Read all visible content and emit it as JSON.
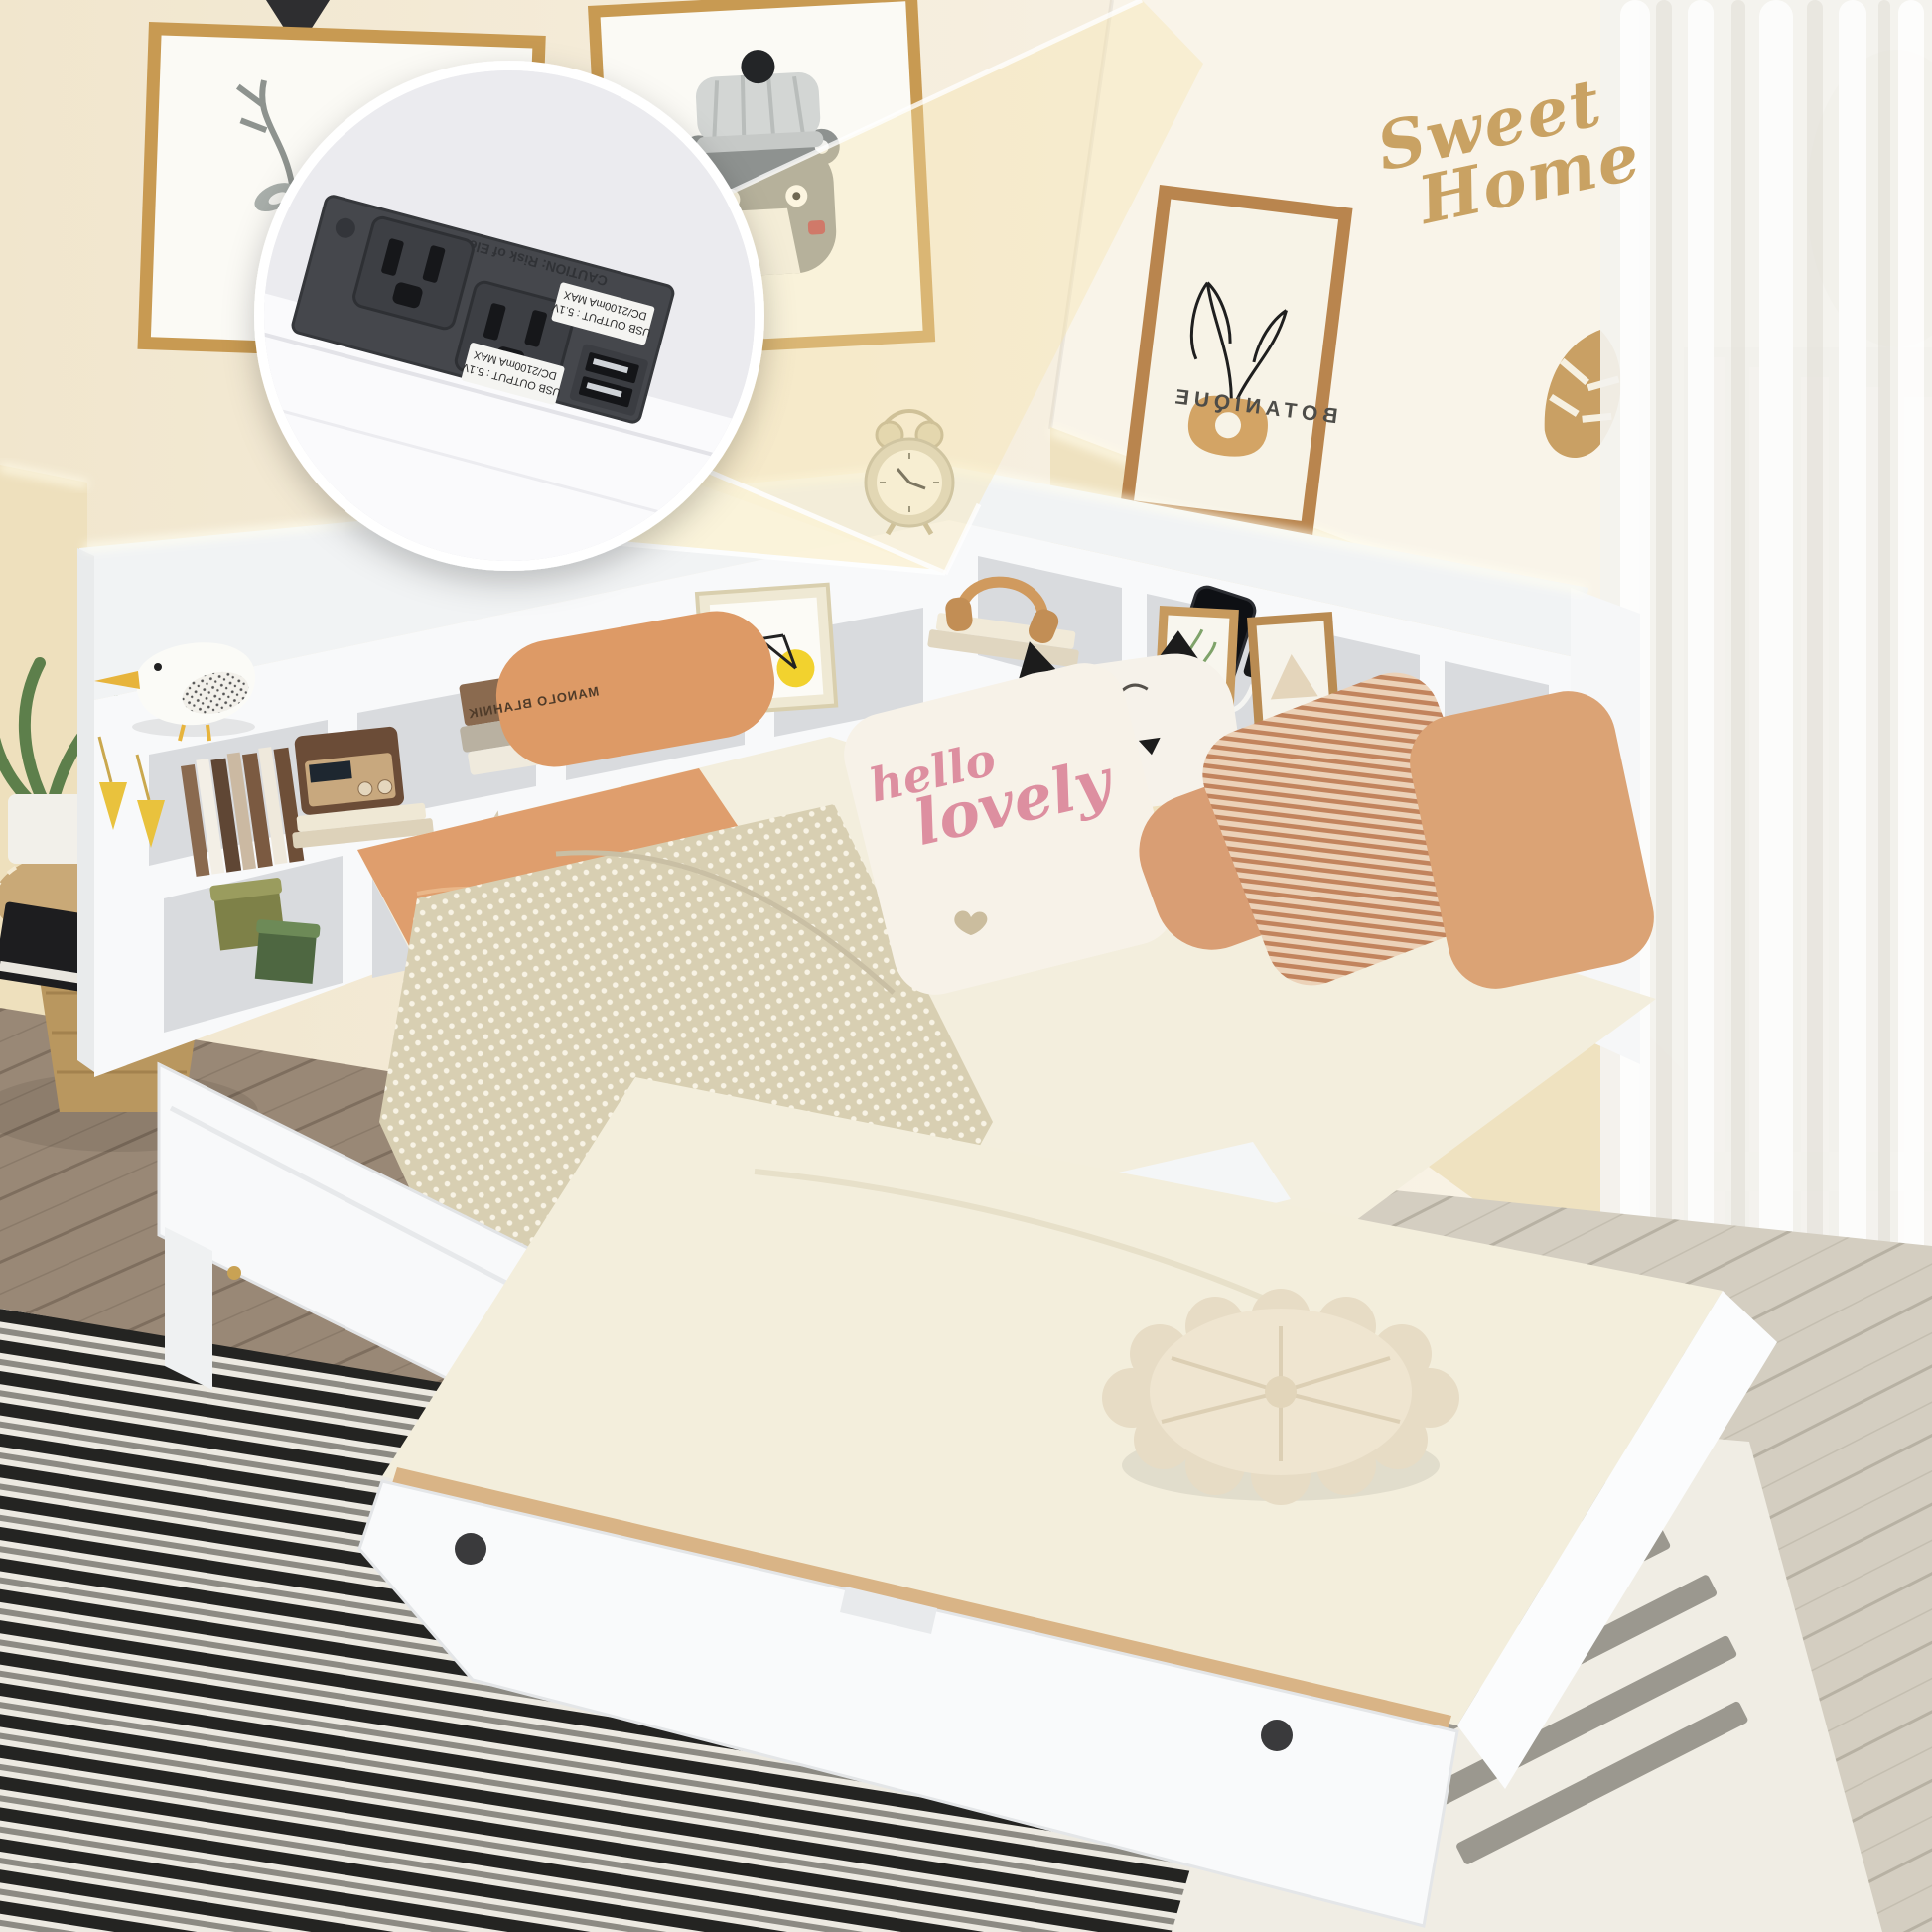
{
  "wall_decal": {
    "line1": "Sweet",
    "line2": "Home"
  },
  "pillow": {
    "script_line1": "hello",
    "script_line2": "lovely"
  },
  "poster": {
    "title": "BOTANIQUE"
  },
  "book": {
    "spine_title": "MANOLO BLAHNIK"
  },
  "charging_station": {
    "usb_label1_line1": "USB OUTPUT : 5.1V",
    "usb_label1_line2": "DC/2100mA MAX",
    "usb_label2_line1": "USB OUTPUT : 5.1V",
    "usb_label2_line2": "DC/2100mA MAX",
    "caution_text": "CAUTION: Risk of Electric Shock"
  },
  "icons": {
    "charge_indicator": "lightning-bolt-icon",
    "charge_glyph": "⚡",
    "magnifier_inset": "zoom-circle-icon"
  },
  "colors": {
    "wall_cream": "#f4ebd6",
    "wainscot_beige": "#eee0bd",
    "headboard_white": "#f7f8f9",
    "sheet_orange": "#df9e6d",
    "blanket_beige": "#d8cfb2",
    "pillow_pink_text": "#dd8fa0",
    "gold_accent": "#c9a263",
    "frame_gold": "#c89a52",
    "rug_dark": "#242422",
    "rug_light": "#edeae2",
    "floor_wood": "#9a8a79",
    "floor_light": "#d6d0c3",
    "outlet_panel": "#45474c",
    "charge_green": "#38d387"
  }
}
